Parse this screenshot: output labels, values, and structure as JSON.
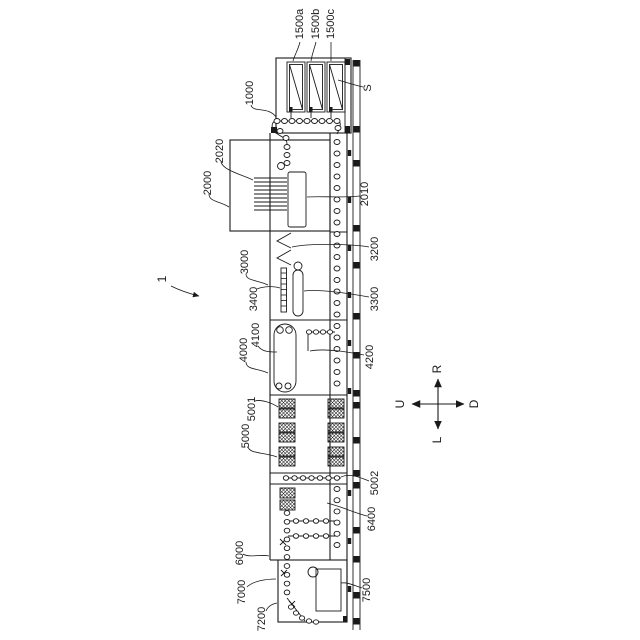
{
  "figure": {
    "number": "1"
  },
  "reference_labels": {
    "1000": "1000",
    "1500a": "1500a",
    "1500b": "1500b",
    "1500c": "1500c",
    "s": "S",
    "2000": "2000",
    "2020": "2020",
    "2010": "2010",
    "3000": "3000",
    "3200": "3200",
    "3300": "3300",
    "3400": "3400",
    "4000": "4000",
    "4100": "4100",
    "4200": "4200",
    "5000": "5000",
    "5001": "5001",
    "5002": "5002",
    "6000": "6000",
    "6400": "6400",
    "7000": "7000",
    "7200": "7200",
    "7500": "7500"
  },
  "compass": {
    "up_label": "R",
    "down_label": "L",
    "left_label": "U",
    "right_label": "D"
  },
  "colors": {
    "background": "#ffffff",
    "line_color": "#1a1a1a"
  }
}
